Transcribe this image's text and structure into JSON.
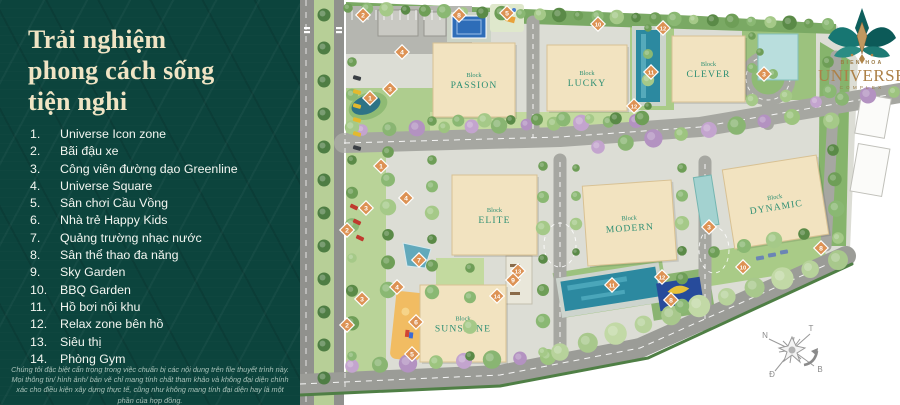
{
  "panel": {
    "title_lines": [
      "Trải nghiệm",
      "phong cách sống",
      "tiện nghi"
    ],
    "legend": [
      {
        "num": "1.",
        "label": "Universe Icon zone"
      },
      {
        "num": "2.",
        "label": "Bãi đậu xe"
      },
      {
        "num": "3.",
        "label": "Công viên đường dạo Greenline"
      },
      {
        "num": "4.",
        "label": "Universe Square"
      },
      {
        "num": "5.",
        "label": "Sân chơi Cầu Vồng"
      },
      {
        "num": "6.",
        "label": "Nhà trẻ Happy Kids"
      },
      {
        "num": "7.",
        "label": "Quảng trường nhạc nước"
      },
      {
        "num": "8.",
        "label": "Sân thể thao đa năng"
      },
      {
        "num": "9.",
        "label": "Sky Garden"
      },
      {
        "num": "10.",
        "label": "BBQ Garden"
      },
      {
        "num": "11.",
        "label": "Hồ bơi nội khu"
      },
      {
        "num": "12.",
        "label": "Relax zone bên hồ"
      },
      {
        "num": "13.",
        "label": "Siêu thị"
      },
      {
        "num": "14.",
        "label": "Phòng Gym"
      }
    ],
    "disclaimer": "Chúng tôi đặc biệt cẩn trọng trong việc chuẩn bị các nội dung trên file thuyết trình này. Mọi thông tin/ hình ảnh/ bản vẽ chỉ mang tính chất tham khảo và không đại diện chính xác cho điều kiện xây dựng thực tế, cũng như không mang tính đại diện hay là một phần của hợp đồng."
  },
  "logo": {
    "location": "BIEN HOA",
    "name": "UNIVERSE",
    "suffix": "COMPLEX"
  },
  "map": {
    "block_word": "Block",
    "blocks": [
      {
        "name": "PASSION",
        "x": 433,
        "y": 43,
        "w": 82,
        "h": 74,
        "rot": 0
      },
      {
        "name": "LUCKY",
        "x": 547,
        "y": 45,
        "w": 80,
        "h": 66,
        "rot": 0
      },
      {
        "name": "CLEVER",
        "x": 672,
        "y": 36,
        "w": 73,
        "h": 66,
        "rot": 0
      },
      {
        "name": "ELITE",
        "x": 452,
        "y": 175,
        "w": 85,
        "h": 80,
        "rot": 0
      },
      {
        "name": "MODERN",
        "x": 585,
        "y": 183,
        "w": 89,
        "h": 80,
        "rot": -4
      },
      {
        "name": "DYNAMIC",
        "x": 728,
        "y": 162,
        "w": 95,
        "h": 80,
        "rot": -9
      },
      {
        "name": "SUNSHINE",
        "x": 420,
        "y": 285,
        "w": 86,
        "h": 77,
        "rot": 0
      }
    ],
    "markers": [
      {
        "n": "2",
        "x": 363,
        "y": 15
      },
      {
        "n": "8",
        "x": 459,
        "y": 15
      },
      {
        "n": "5",
        "x": 507,
        "y": 13
      },
      {
        "n": "4",
        "x": 402,
        "y": 52
      },
      {
        "n": "10",
        "x": 598,
        "y": 24
      },
      {
        "n": "12",
        "x": 663,
        "y": 28
      },
      {
        "n": "11",
        "x": 651,
        "y": 72
      },
      {
        "n": "3",
        "x": 390,
        "y": 89
      },
      {
        "n": "1",
        "x": 370,
        "y": 98
      },
      {
        "n": "12",
        "x": 634,
        "y": 106
      },
      {
        "n": "3",
        "x": 764,
        "y": 74
      },
      {
        "n": "1",
        "x": 381,
        "y": 166
      },
      {
        "n": "4",
        "x": 406,
        "y": 198
      },
      {
        "n": "3",
        "x": 366,
        "y": 208
      },
      {
        "n": "2",
        "x": 347,
        "y": 230
      },
      {
        "n": "7",
        "x": 419,
        "y": 260
      },
      {
        "n": "3",
        "x": 709,
        "y": 227
      },
      {
        "n": "8",
        "x": 821,
        "y": 248
      },
      {
        "n": "4",
        "x": 397,
        "y": 287
      },
      {
        "n": "3",
        "x": 362,
        "y": 299
      },
      {
        "n": "13",
        "x": 518,
        "y": 271
      },
      {
        "n": "9",
        "x": 513,
        "y": 280
      },
      {
        "n": "10",
        "x": 743,
        "y": 267
      },
      {
        "n": "12",
        "x": 662,
        "y": 277
      },
      {
        "n": "11",
        "x": 612,
        "y": 285
      },
      {
        "n": "14",
        "x": 497,
        "y": 296
      },
      {
        "n": "6",
        "x": 416,
        "y": 322
      },
      {
        "n": "2",
        "x": 347,
        "y": 325
      },
      {
        "n": "8",
        "x": 671,
        "y": 300
      },
      {
        "n": "5",
        "x": 412,
        "y": 354
      }
    ],
    "compass": [
      {
        "label": "N",
        "x": 765,
        "y": 338
      },
      {
        "label": "T",
        "x": 811,
        "y": 331
      },
      {
        "label": "Đ",
        "x": 772,
        "y": 377
      },
      {
        "label": "B",
        "x": 820,
        "y": 372
      }
    ]
  },
  "colors": {
    "panel_bg": "#0c443d",
    "title": "#f0e4c4",
    "marker": "#dd9254",
    "building": "#f2e3c0",
    "block_label": "#2e8f73",
    "pool": "#2c89a0",
    "court": "#2e6db8",
    "logo_gold": "#ad8148",
    "logo_teal": "#13706d"
  }
}
